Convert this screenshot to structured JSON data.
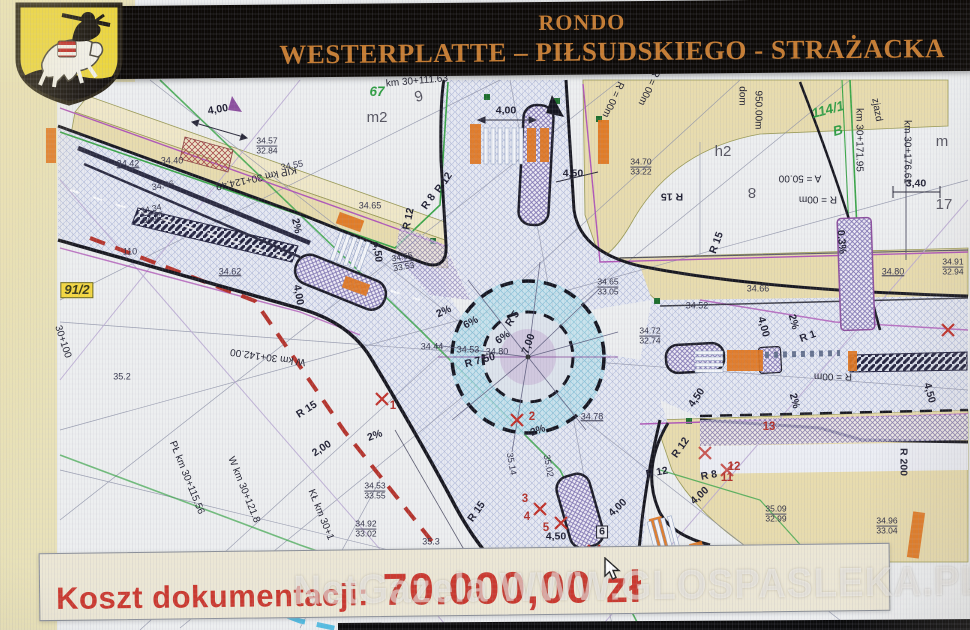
{
  "header": {
    "line1": "RONDO",
    "line2": "WESTERPLATTE – PIŁSUDSKIEGO - STRAŻACKA",
    "bg_color": "#0d0a07",
    "text_color": "#c67c31"
  },
  "crest": {
    "name": "herb-paslek",
    "shield_color": "#ecd63f"
  },
  "cost_banner": {
    "label": "Koszt dokumentacji:",
    "amount": "70.000,00 zł",
    "bg_color": "#ece7d5",
    "text_color": "#cb392f"
  },
  "watermark": {
    "text": "NetGazela WWW.GLOSPASLEKA.PL"
  },
  "plan": {
    "description": "road design drawing of roundabout",
    "labels": [
      {
        "t": "4,00",
        "x": 218,
        "y": 110,
        "r": -10,
        "cls": "dim"
      },
      {
        "t": "4,00",
        "x": 506,
        "y": 111,
        "cls": "dim"
      },
      {
        "t": "4,50",
        "x": 573,
        "y": 174,
        "cls": "dim"
      },
      {
        "t": "R 12",
        "x": 444,
        "y": 183,
        "r": -55,
        "cls": "dim"
      },
      {
        "t": "R 8",
        "x": 429,
        "y": 202,
        "r": -55,
        "cls": "dim"
      },
      {
        "t": "R 12",
        "x": 409,
        "y": 219,
        "r": -78,
        "cls": "dim"
      },
      {
        "t": "4,50",
        "x": 377,
        "y": 252,
        "r": 84,
        "cls": "dim"
      },
      {
        "t": "4,00",
        "x": 298,
        "y": 295,
        "r": 80,
        "cls": "dim"
      },
      {
        "t": "2%",
        "x": 296,
        "y": 226,
        "r": 78,
        "cls": "dim"
      },
      {
        "t": "2%",
        "x": 444,
        "y": 312,
        "r": -25,
        "cls": "dim"
      },
      {
        "t": "6%",
        "x": 471,
        "y": 323,
        "r": -28,
        "cls": "dim"
      },
      {
        "t": "6%",
        "x": 503,
        "y": 338,
        "r": -35,
        "cls": "dim"
      },
      {
        "t": "R 5",
        "x": 513,
        "y": 319,
        "r": -55,
        "cls": "dim"
      },
      {
        "t": "7,00",
        "x": 529,
        "y": 344,
        "r": -70,
        "cls": "dim"
      },
      {
        "t": "R 7,50",
        "x": 480,
        "y": 361,
        "r": -15,
        "cls": "dim"
      },
      {
        "t": "R 15",
        "x": 672,
        "y": 196,
        "r": 180,
        "cls": "dim"
      },
      {
        "t": "R 15",
        "x": 717,
        "y": 243,
        "r": -70,
        "cls": "dim"
      },
      {
        "t": "R 15",
        "x": 307,
        "y": 410,
        "r": -33,
        "cls": "dim"
      },
      {
        "t": "2,00",
        "x": 322,
        "y": 449,
        "r": -33,
        "cls": "dim"
      },
      {
        "t": "R 15",
        "x": 477,
        "y": 512,
        "r": -55,
        "cls": "dim"
      },
      {
        "t": "2%",
        "x": 375,
        "y": 436,
        "r": -20,
        "cls": "dim"
      },
      {
        "t": "2%",
        "x": 538,
        "y": 431,
        "r": -20,
        "cls": "dim"
      },
      {
        "t": "4,50",
        "x": 556,
        "y": 537,
        "cls": "dim"
      },
      {
        "t": "4,00",
        "x": 618,
        "y": 508,
        "r": -42,
        "cls": "dim"
      },
      {
        "t": "4,00",
        "x": 700,
        "y": 496,
        "r": -42,
        "cls": "dim"
      },
      {
        "t": "4,50",
        "x": 697,
        "y": 398,
        "r": -55,
        "cls": "dim"
      },
      {
        "t": "R 12",
        "x": 681,
        "y": 448,
        "r": -55,
        "cls": "dim"
      },
      {
        "t": "R 8",
        "x": 709,
        "y": 476,
        "r": -10,
        "cls": "dim"
      },
      {
        "t": "R 12",
        "x": 657,
        "y": 473,
        "r": -10,
        "cls": "dim"
      },
      {
        "t": "4,00",
        "x": 763,
        "y": 327,
        "r": 75,
        "cls": "dim"
      },
      {
        "t": "4,50",
        "x": 929,
        "y": 393,
        "r": 75,
        "cls": "dim"
      },
      {
        "t": "2%",
        "x": 793,
        "y": 322,
        "r": 75,
        "cls": "dim"
      },
      {
        "t": "2%",
        "x": 794,
        "y": 401,
        "r": 75,
        "cls": "dim"
      },
      {
        "t": "R 1",
        "x": 808,
        "y": 337,
        "r": -20,
        "cls": "dim"
      },
      {
        "t": "R 200",
        "x": 903,
        "y": 462,
        "r": 90,
        "cls": "dim"
      },
      {
        "t": "0.3%",
        "x": 841,
        "y": 242,
        "r": 85,
        "cls": "dim"
      },
      {
        "t": "3,40",
        "x": 916,
        "y": 184,
        "cls": "dim"
      },
      {
        "t": "KIP km 30+124.49",
        "x": 256,
        "y": 177,
        "r": 168,
        "cls": "sta"
      },
      {
        "t": "W km 30+142.00",
        "x": 268,
        "y": 356,
        "r": 188,
        "cls": "sta"
      },
      {
        "t": "PŁ km 30+115.56",
        "x": 186,
        "y": 478,
        "r": 68,
        "cls": "sta"
      },
      {
        "t": "W km 30+121.8",
        "x": 243,
        "y": 490,
        "r": 68,
        "cls": "sta"
      },
      {
        "t": "KŁ km 30+1",
        "x": 320,
        "y": 515,
        "r": 68,
        "cls": "sta"
      },
      {
        "t": "30+100",
        "x": 62,
        "y": 342,
        "r": 72,
        "cls": "sta"
      },
      {
        "t": "km 30+171.95",
        "x": 858,
        "y": 140,
        "r": 90,
        "cls": "sta"
      },
      {
        "t": "km 30+176.61",
        "x": 906,
        "y": 152,
        "r": 90,
        "cls": "sta"
      },
      {
        "t": "zjazd",
        "x": 876,
        "y": 110,
        "r": 80,
        "cls": "sta"
      },
      {
        "t": "950.00m",
        "x": 757,
        "y": 110,
        "r": 90,
        "cls": "sta"
      },
      {
        "t": "dom",
        "x": 741,
        "y": 96,
        "r": 90,
        "cls": "sta"
      },
      {
        "t": "km 30+111.63",
        "x": 417,
        "y": 82,
        "r": -5,
        "cls": "sta"
      },
      {
        "t": "A = 50.00",
        "x": 800,
        "y": 177,
        "r": 180,
        "cls": "sta"
      },
      {
        "t": "R = 00m",
        "x": 818,
        "y": 198,
        "r": 180,
        "cls": "sta"
      },
      {
        "t": "R = 00m",
        "x": 833,
        "y": 375,
        "r": 180,
        "cls": "sta"
      },
      {
        "t": "R = 00m",
        "x": 612,
        "y": 99,
        "r": 115,
        "cls": "sta"
      },
      {
        "t": "R = 00m",
        "x": 648,
        "y": 87,
        "r": 115,
        "cls": "sta"
      },
      {
        "t": "34.57",
        "sub": "32.84",
        "x": 267,
        "y": 146
      },
      {
        "t": "34.70",
        "sub": "33.22",
        "x": 641,
        "y": 167
      },
      {
        "t": "34.91",
        "sub": "32.94",
        "x": 953,
        "y": 267
      },
      {
        "t": "34.65",
        "sub": "33.05",
        "x": 608,
        "y": 287
      },
      {
        "t": "34.53",
        "sub": "33.55",
        "x": 375,
        "y": 491
      },
      {
        "t": "34.92",
        "sub": "33.02",
        "x": 366,
        "y": 529
      },
      {
        "t": "35.09",
        "sub": "32.99",
        "x": 776,
        "y": 514
      },
      {
        "t": "34.96",
        "sub": "33.04",
        "x": 887,
        "y": 526
      },
      {
        "t": "34.72",
        "sub": "32.74",
        "x": 650,
        "y": 336
      },
      {
        "t": "34.34",
        "sub": "34.42",
        "x": 152,
        "y": 214,
        "r": -12
      },
      {
        "t": "34.65",
        "sub": "33.53",
        "x": 403,
        "y": 262,
        "r": -10
      },
      {
        "t": "34.42",
        "x": 128,
        "y": 164,
        "u": 1
      },
      {
        "t": "34.40",
        "x": 172,
        "y": 161
      },
      {
        "t": "34.46",
        "x": 163,
        "y": 186,
        "r": -10
      },
      {
        "t": "34.55",
        "x": 292,
        "y": 166,
        "r": -10
      },
      {
        "t": "34.62",
        "x": 230,
        "y": 272,
        "u": 1
      },
      {
        "t": "34.65",
        "x": 370,
        "y": 206
      },
      {
        "t": "110",
        "x": 130,
        "y": 252
      },
      {
        "t": "35.2",
        "x": 122,
        "y": 377
      },
      {
        "t": "35.3",
        "x": 431,
        "y": 542
      },
      {
        "t": "34.66",
        "x": 758,
        "y": 289
      },
      {
        "t": "34.52",
        "x": 697,
        "y": 306
      },
      {
        "t": "34.80",
        "x": 893,
        "y": 272,
        "u": 1
      },
      {
        "t": "34.78",
        "x": 592,
        "y": 417,
        "u": 1
      },
      {
        "t": "35.14",
        "x": 511,
        "y": 464,
        "r": 80
      },
      {
        "t": "35.02",
        "x": 548,
        "y": 466,
        "r": 80
      },
      {
        "t": "34.44",
        "x": 432,
        "y": 347
      },
      {
        "t": "34.53",
        "x": 468,
        "y": 350
      },
      {
        "t": "34.80",
        "x": 497,
        "y": 352
      },
      {
        "t": "91/2",
        "x": 77,
        "y": 290,
        "cls": "parcel-yellow"
      },
      {
        "t": "67",
        "x": 377,
        "y": 92,
        "cls": "parcel-green"
      },
      {
        "t": "114/1",
        "x": 828,
        "y": 110,
        "r": -15,
        "cls": "parcel-green"
      },
      {
        "t": "B",
        "x": 838,
        "y": 131,
        "r": -15,
        "cls": "parcel-green"
      },
      {
        "t": "m2",
        "x": 377,
        "y": 118,
        "cls": "zone"
      },
      {
        "t": "9",
        "x": 419,
        "y": 97,
        "r": -15,
        "cls": "zone"
      },
      {
        "t": "h2",
        "x": 723,
        "y": 152,
        "cls": "zone"
      },
      {
        "t": "8",
        "x": 752,
        "y": 192,
        "r": 180,
        "cls": "zone"
      },
      {
        "t": "17",
        "x": 944,
        "y": 205,
        "cls": "zone"
      },
      {
        "t": "m",
        "x": 942,
        "y": 142,
        "cls": "zone"
      },
      {
        "t": "1",
        "x": 393,
        "y": 406,
        "cls": "mk"
      },
      {
        "t": "2",
        "x": 532,
        "y": 417,
        "cls": "mk"
      },
      {
        "t": "3",
        "x": 525,
        "y": 499,
        "cls": "mk"
      },
      {
        "t": "4",
        "x": 527,
        "y": 517,
        "cls": "mk"
      },
      {
        "t": "5",
        "x": 546,
        "y": 528,
        "cls": "mk"
      },
      {
        "t": "6",
        "x": 602,
        "y": 532,
        "cls": "mk-box"
      },
      {
        "t": "11",
        "x": 727,
        "y": 478,
        "cls": "mk"
      },
      {
        "t": "12",
        "x": 734,
        "y": 467,
        "cls": "mk"
      },
      {
        "t": "13",
        "x": 769,
        "y": 427,
        "cls": "mk"
      }
    ]
  }
}
